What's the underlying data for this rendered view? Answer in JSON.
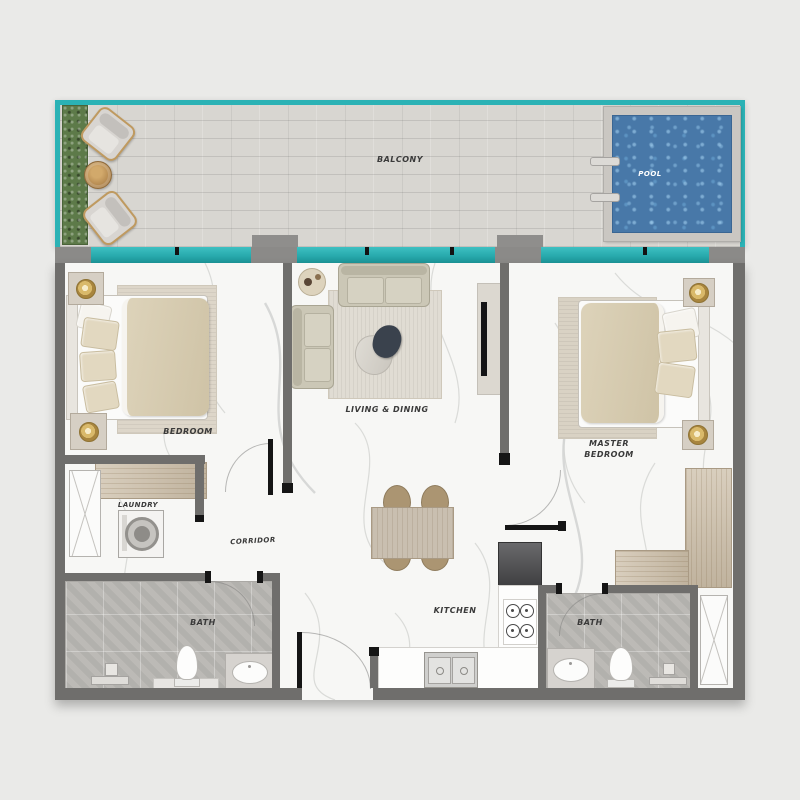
{
  "rooms": {
    "balcony": {
      "label": "BALCONY"
    },
    "pool": {
      "label": "POOL"
    },
    "bedroom": {
      "label": "BEDROOM"
    },
    "living_dining": {
      "label": "LIVING & DINING"
    },
    "master_bedroom": {
      "label": "MASTER BEDROOM"
    },
    "laundry": {
      "label": "LAUNDRY"
    },
    "corridor": {
      "label": "CORRIDOR"
    },
    "kitchen": {
      "label": "KITCHEN"
    },
    "bath_left": {
      "label": "BATH"
    },
    "bath_right": {
      "label": "BATH"
    }
  },
  "colors": {
    "background": "#eaeae8",
    "glass_teal": "#2bb2b5",
    "pool_water": "#4878a8",
    "pool_deck": "#cac7c2",
    "wall_gray": "#6f6e6c",
    "door_black": "#151515",
    "marble_floor": "#f7f7f5",
    "balcony_deck": "#d8d6d1",
    "bath_tile": "#bcbab6",
    "wood": "#ccbea8",
    "hedge_green": "#5d7a49",
    "bed_beige": "#d8cdb4",
    "label_text": "#3a3a3a"
  },
  "furniture": [
    "hedge-planter",
    "lounge-chair",
    "outdoor-round-table",
    "pool-ladder",
    "double-bed",
    "nightstand-with-lamp",
    "area-rug",
    "built-in-wardrobe",
    "sliding-closet",
    "washing-machine",
    "sofa",
    "coffee-table",
    "side-table",
    "decor-tray",
    "tv-unit",
    "dining-table",
    "dining-chair",
    "refrigerator",
    "gas-hob",
    "kitchen-double-sink",
    "kitchen-counter",
    "toilet",
    "washbasin-counter",
    "shower",
    "l-shaped-wardrobe"
  ]
}
